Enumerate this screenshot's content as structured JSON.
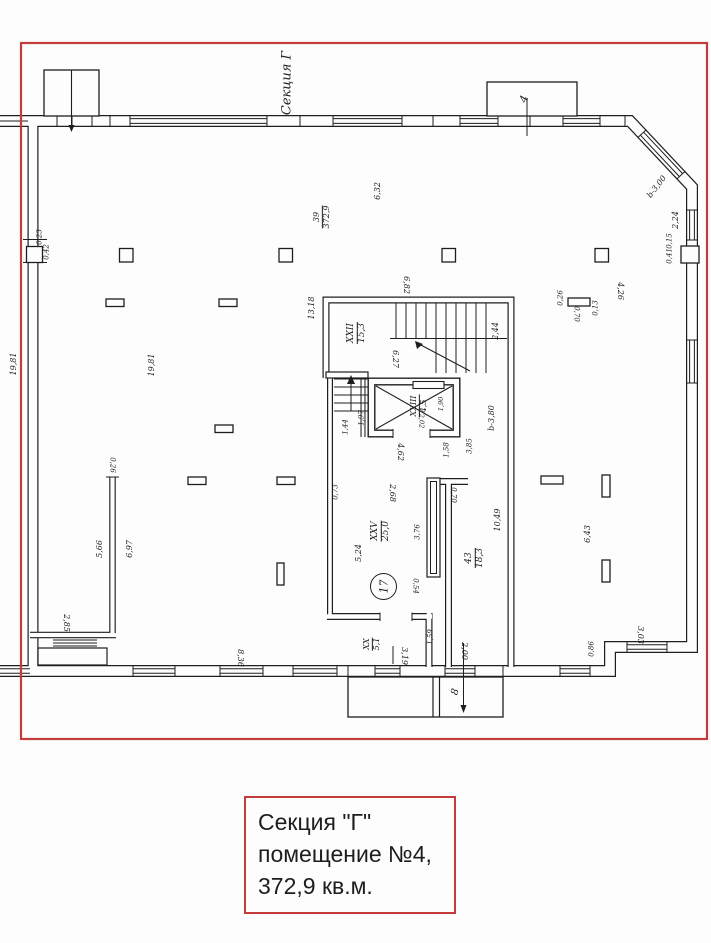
{
  "caption": {
    "lines": [
      "Секция \"Г\"",
      "помещение №4,",
      "372,9 кв.м."
    ]
  },
  "colors": {
    "frame_red": "#c43c3c",
    "ink": "#1e1e1e",
    "paper": "#fdfdfd"
  },
  "plan": {
    "labels": [
      {
        "text": "Секция Г",
        "x": 287,
        "y": 83,
        "r": -90,
        "fs": 13,
        "kind": "section-label"
      },
      {
        "text": "4",
        "x": 524,
        "y": 99,
        "r": -70,
        "fs": 11,
        "kind": "balcony-label"
      },
      {
        "text": "8",
        "x": 456,
        "y": 692,
        "r": -75,
        "fs": 10,
        "kind": "porch-label"
      },
      {
        "text": "b-3,00",
        "x": 657,
        "y": 187,
        "r": -52,
        "fs": 8
      },
      {
        "text": "2,24",
        "x": 676,
        "y": 220,
        "r": -90,
        "fs": 8
      },
      {
        "text": "0,15",
        "x": 670,
        "y": 241,
        "r": -90,
        "fs": 7
      },
      {
        "text": "0,41",
        "x": 670,
        "y": 256,
        "r": -90,
        "fs": 7
      },
      {
        "text": "6,32",
        "x": 378,
        "y": 191,
        "r": -90,
        "fs": 8
      },
      {
        "text": "0,23",
        "x": 40,
        "y": 237,
        "r": -90,
        "fs": 7
      },
      {
        "text": "0,42",
        "x": 47,
        "y": 252,
        "r": -90,
        "fs": 7
      },
      {
        "text": "19,81",
        "x": 14,
        "y": 364,
        "r": -90,
        "fs": 8
      },
      {
        "text": "19,81",
        "x": 152,
        "y": 365,
        "r": -90,
        "fs": 8
      },
      {
        "text": "13,18",
        "x": 312,
        "y": 308,
        "r": -90,
        "fs": 8
      },
      {
        "text": "6,82",
        "x": 406,
        "y": 285,
        "r": 90,
        "fs": 8
      },
      {
        "text": "2,44",
        "x": 496,
        "y": 331,
        "r": -90,
        "fs": 8
      },
      {
        "text": "6,27",
        "x": 395,
        "y": 359,
        "r": 90,
        "fs": 8
      },
      {
        "text": "1,90",
        "x": 441,
        "y": 404,
        "r": -90,
        "fs": 6.5
      },
      {
        "text": "2,02",
        "x": 421,
        "y": 421,
        "r": 90,
        "fs": 6.5
      },
      {
        "text": "1,97",
        "x": 362,
        "y": 418,
        "r": -90,
        "fs": 7
      },
      {
        "text": "1,44",
        "x": 346,
        "y": 427,
        "r": -90,
        "fs": 7
      },
      {
        "text": "4,62",
        "x": 400,
        "y": 452,
        "r": 90,
        "fs": 8
      },
      {
        "text": "1,58",
        "x": 447,
        "y": 450,
        "r": -90,
        "fs": 7
      },
      {
        "text": "3,85",
        "x": 470,
        "y": 446,
        "r": -90,
        "fs": 7
      },
      {
        "text": "b-3,80",
        "x": 492,
        "y": 418,
        "r": -90,
        "fs": 8
      },
      {
        "text": "0,26",
        "x": 112,
        "y": 465,
        "r": 90,
        "fs": 7
      },
      {
        "text": "5,66",
        "x": 100,
        "y": 549,
        "r": -90,
        "fs": 8
      },
      {
        "text": "6,97",
        "x": 130,
        "y": 549,
        "r": -90,
        "fs": 8
      },
      {
        "text": "0,73",
        "x": 336,
        "y": 492,
        "r": -90,
        "fs": 7
      },
      {
        "text": "2,68",
        "x": 392,
        "y": 493,
        "r": 90,
        "fs": 8
      },
      {
        "text": "3,76",
        "x": 418,
        "y": 532,
        "r": -90,
        "fs": 7
      },
      {
        "text": "5,24",
        "x": 359,
        "y": 553,
        "r": -90,
        "fs": 8
      },
      {
        "text": "0,54",
        "x": 415,
        "y": 586,
        "r": 90,
        "fs": 7
      },
      {
        "text": "10,49",
        "x": 498,
        "y": 520,
        "r": -90,
        "fs": 8
      },
      {
        "text": "0,70",
        "x": 453,
        "y": 495,
        "r": 90,
        "fs": 7
      },
      {
        "text": "6,43",
        "x": 588,
        "y": 534,
        "r": -90,
        "fs": 8
      },
      {
        "text": "3,19",
        "x": 404,
        "y": 656,
        "r": 90,
        "fs": 8
      },
      {
        "text": "1,59",
        "x": 431,
        "y": 637,
        "r": -90,
        "fs": 7
      },
      {
        "text": "2,00",
        "x": 464,
        "y": 651,
        "r": 90,
        "fs": 8
      },
      {
        "text": "8,36",
        "x": 240,
        "y": 658,
        "r": 90,
        "fs": 8
      },
      {
        "text": "2,85",
        "x": 66,
        "y": 623,
        "r": 90,
        "fs": 8
      },
      {
        "text": "3,03",
        "x": 640,
        "y": 635,
        "r": 90,
        "fs": 8
      },
      {
        "text": "0,86",
        "x": 592,
        "y": 649,
        "r": -90,
        "fs": 7
      },
      {
        "text": "4,26",
        "x": 620,
        "y": 291,
        "r": 90,
        "fs": 8
      },
      {
        "text": "0,26",
        "x": 561,
        "y": 298,
        "r": -90,
        "fs": 7
      },
      {
        "text": "0,70",
        "x": 576,
        "y": 314,
        "r": 90,
        "fs": 7
      },
      {
        "text": "0,13",
        "x": 596,
        "y": 308,
        "r": -90,
        "fs": 7
      }
    ],
    "fractions": [
      {
        "top": "39",
        "bottom": "372,9",
        "x": 322,
        "y": 217,
        "r": -90,
        "fs": 8,
        "kind": "room-area-label"
      },
      {
        "top": "XXII",
        "bottom": "15,3",
        "x": 357,
        "y": 333,
        "r": -90,
        "fs": 9,
        "kind": "stair-room-label"
      },
      {
        "top": "XXIII",
        "bottom": "4,5",
        "x": 419,
        "y": 406,
        "r": -90,
        "fs": 8,
        "kind": "elevator-room-label"
      },
      {
        "top": "XXV",
        "bottom": "25,0",
        "x": 381,
        "y": 531,
        "r": -90,
        "fs": 9,
        "kind": "room-label"
      },
      {
        "top": "43",
        "bottom": "18,3",
        "x": 475,
        "y": 558,
        "r": -90,
        "fs": 9,
        "kind": "corridor-label"
      },
      {
        "top": "XX",
        "bottom": "5,1",
        "x": 372,
        "y": 644,
        "r": -90,
        "fs": 8,
        "kind": "room-label"
      }
    ],
    "circle_marker": {
      "text": "17",
      "x": 383,
      "y": 586
    }
  }
}
